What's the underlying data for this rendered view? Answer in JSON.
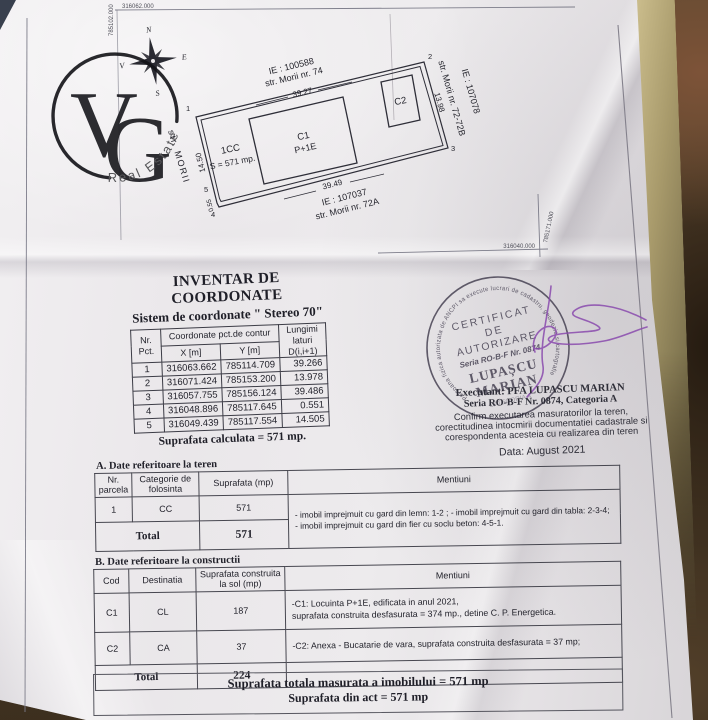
{
  "logo": {
    "monogram_v": "V",
    "monogram_g": "G",
    "subtitle": "Real Estate"
  },
  "grid": {
    "top_left": {
      "x_label": "316062.000",
      "y_label": "785102.000"
    },
    "bottom_right": {
      "x_label": "316040.000",
      "y_label": "785171.000"
    }
  },
  "compass": {
    "north": "N",
    "south": "S",
    "west": "V",
    "east": "E"
  },
  "plan": {
    "neighbor_top": {
      "ie": "IE :  100588",
      "street": "str. Morii nr. 74"
    },
    "neighbor_right": {
      "ie": "IE :  107078",
      "street": "str. Morii nr. 72-72B"
    },
    "neighbor_bottom": {
      "ie": "IE :  107037",
      "street": "str. Morii  nr. 72A"
    },
    "street_left": "str. MORII",
    "parcel_label": "1CC",
    "parcel_area": "S = 571 mp.",
    "c1_code": "C1",
    "c1_regime": "P+1E",
    "c2_code": "C2",
    "dim_top": "39.27",
    "dim_left": "14.50",
    "dim_right": "13.98",
    "dim_bottom": "39.49",
    "dim_corner": "0.55",
    "corner1": "1",
    "corner2": "2",
    "corner3": "3",
    "corner4": "4",
    "corner5": "5"
  },
  "coord_table": {
    "title": "INVENTAR DE COORDONATE",
    "subtitle": "Sistem de coordonate \" Stereo 70\"",
    "header_nr": "Nr.\nPct.",
    "header_coord": "Coordonate pct.de contur",
    "header_x": "X [m]",
    "header_y": "Y [m]",
    "header_d": "Lungimi\nlaturi\nD(i,i+1)",
    "rows": [
      {
        "nr": "1",
        "x": "316063.662",
        "y": "785114.709",
        "d": "39.266"
      },
      {
        "nr": "2",
        "x": "316071.424",
        "y": "785153.200",
        "d": "13.978"
      },
      {
        "nr": "3",
        "x": "316057.755",
        "y": "785156.124",
        "d": "39.486"
      },
      {
        "nr": "4",
        "x": "316048.896",
        "y": "785117.645",
        "d": "0.551"
      },
      {
        "nr": "5",
        "x": "316049.439",
        "y": "785117.554",
        "d": "14.505"
      }
    ],
    "footer": "Suprafata calculata = 571 mp."
  },
  "stamp": {
    "ring": "Persoana fizica autorizata de ANCPI sa execute lucrari de cadastru, geodezie si cartografie",
    "line1": "CERTIFICAT",
    "line2": "DE",
    "line3": "AUTORIZARE",
    "line4": "Seria RO-B-F Nr. 0874",
    "name1": "LUPAȘCU",
    "name2": "MARIAN",
    "category": "CATEGORIA A"
  },
  "certification": {
    "executant": "Executant:  PFA  LUPASCU MARIAN",
    "seria": "Seria RO-B-F  Nr. 0874, Categoria A",
    "confirm1": "Confirm executarea masuratorilor la teren,",
    "confirm2": "corectitudinea intocmirii documentatiei cadastrale si",
    "confirm3": "corespondenta acesteia cu realizarea din teren",
    "date": "Data:    August 2021"
  },
  "table_a": {
    "title": "A. Date referitoare la teren",
    "header_nr": "Nr.\nparcela",
    "header_cat": "Categorie de\nfolosinta",
    "header_sup": "Suprafata (mp)",
    "header_ment": "Mentiuni",
    "row_nr": "1",
    "row_cat": "CC",
    "row_sup": "571",
    "mentiuni1": "- imobil  imprejmuit cu gard din lemn: 1-2 ;  - imobil  imprejmuit cu gard din tabla: 2-3-4;",
    "mentiuni2": "- imobil  imprejmuit cu gard din fier cu soclu beton: 4-5-1.",
    "total_label": "Total",
    "total_value": "571"
  },
  "table_b": {
    "title": "B. Date referitoare la constructii",
    "header_cod": "Cod",
    "header_dest": "Destinatia",
    "header_sup": "Suprafata construita\nla sol  (mp)",
    "header_ment": "Mentiuni",
    "rows": [
      {
        "cod": "C1",
        "dest": "CL",
        "sup": "187",
        "ment1": "-C1: Locuinta P+1E,  edificata in anul 2021,",
        "ment2": "suprafata construita  desfasurata = 374 mp.,    detine C. P. Energetica."
      },
      {
        "cod": "C2",
        "dest": "CA",
        "sup": "37",
        "ment1": "-C2: Anexa -  Bucatarie de vara, suprafata construita desfasurata = 37 mp;",
        "ment2": ""
      }
    ],
    "total_label": "Total",
    "total_value": "224"
  },
  "totals": {
    "line1": "Suprafata totala masurata a imobilului = 571 mp",
    "line2": "Suprafata din act = 571 mp"
  }
}
